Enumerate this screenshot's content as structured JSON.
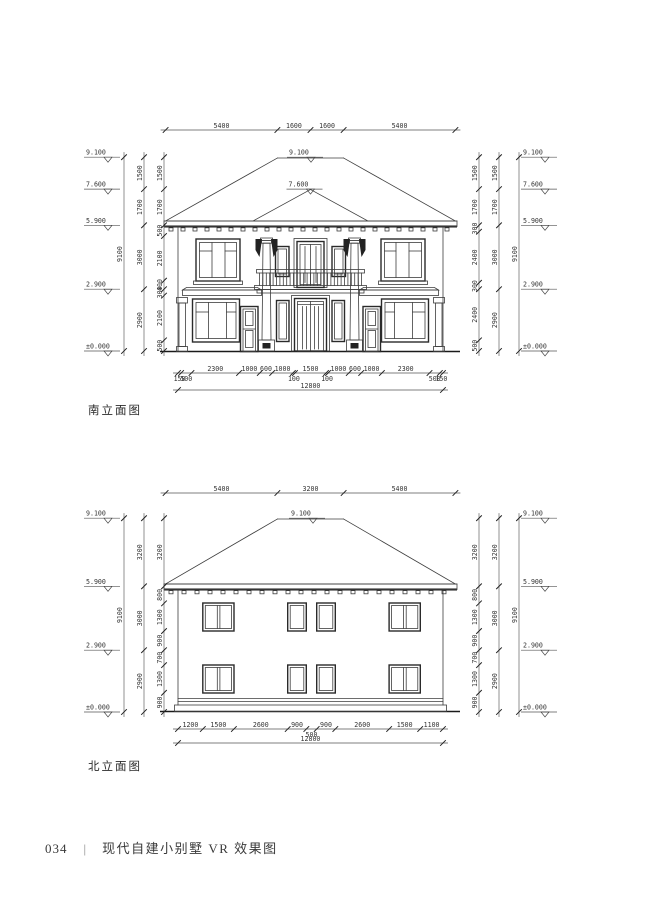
{
  "figures": {
    "south": {
      "caption": "南立面图",
      "top_dims": [
        "5400",
        "1600",
        "1600",
        "5400"
      ],
      "bottom_dims": [
        "150",
        "500",
        "2300",
        "1000",
        "600",
        "1000",
        "100",
        "1500",
        "100",
        "1000",
        "600",
        "1000",
        "2300",
        "500",
        "150"
      ],
      "bottom_total": "12800",
      "left_overall": "9100",
      "left_mid": [
        "1500",
        "1700",
        "3000",
        "2900"
      ],
      "left_inner": [
        "1500",
        "1700",
        "500",
        "2100",
        "400",
        "300",
        "2100",
        "500"
      ],
      "left_levels": [
        "9.100",
        "7.600",
        "5.900",
        "2.900",
        "±0.000"
      ],
      "right_overall": "9100",
      "right_mid": [
        "1500",
        "1700",
        "3000",
        "2900"
      ],
      "right_inner": [
        "1500",
        "1700",
        "300",
        "2400",
        "300",
        "2400",
        "500"
      ],
      "right_levels": [
        "9.100",
        "7.600",
        "5.900",
        "2.900",
        "±0.000"
      ],
      "ridge_level": "9.100",
      "porch_level": "7.600"
    },
    "north": {
      "caption": "北立面图",
      "top_dims": [
        "5400",
        "3200",
        "5400"
      ],
      "bottom_dims": [
        "1200",
        "1500",
        "2600",
        "900",
        "500",
        "900",
        "2600",
        "1500",
        "1100"
      ],
      "bottom_total": "12800",
      "left_overall": "9100",
      "left_mid": [
        "3200",
        "3000",
        "2900"
      ],
      "left_inner": [
        "3200",
        "800",
        "1300",
        "900",
        "700",
        "1300",
        "900"
      ],
      "left_levels": [
        "9.100",
        "5.900",
        "2.900",
        "±0.000"
      ],
      "right_overall": "9100",
      "right_mid": [
        "3200",
        "3000",
        "2900"
      ],
      "right_inner": [
        "3200",
        "800",
        "1300",
        "900",
        "700",
        "1300",
        "900"
      ],
      "right_levels": [
        "9.100",
        "5.900",
        "2.900",
        "±0.000"
      ],
      "ridge_level": "9.100"
    }
  },
  "footer": {
    "page_no": "034",
    "separator": "|",
    "title": "现代自建小别墅 VR 效果图"
  }
}
